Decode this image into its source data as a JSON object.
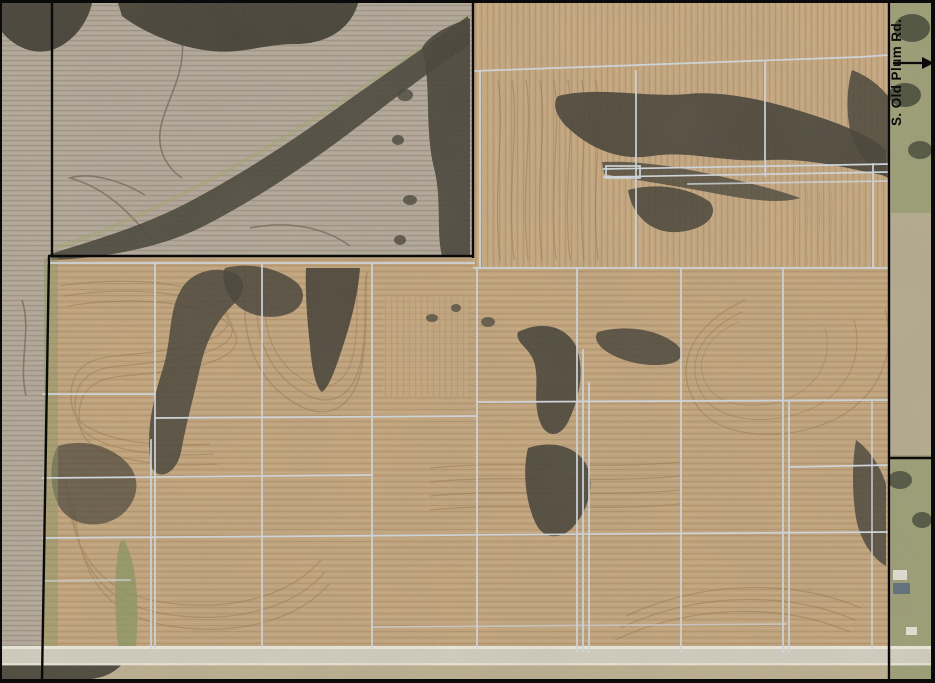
{
  "map": {
    "type": "aerial-parcel-map",
    "road_label": "S. Old Plum Rd.",
    "arrow_icon": "arrow-right",
    "overlay": "drain-tile-lines",
    "colors": {
      "field_tan": "#c4a67e",
      "field_gray": "#b3a99b",
      "tile_line": "#cdd3d8",
      "boundary": "#0a0a0a",
      "road_surface": "#d5d1c3",
      "road_edge": "#efede3",
      "trees_dark": "#454238",
      "grass_green": "#8c9865",
      "building_roof": "#5c6f7d",
      "building_white": "#e8e4da",
      "shoulder_tan": "#b6ae93",
      "subfield_tan": "#beb294"
    }
  }
}
